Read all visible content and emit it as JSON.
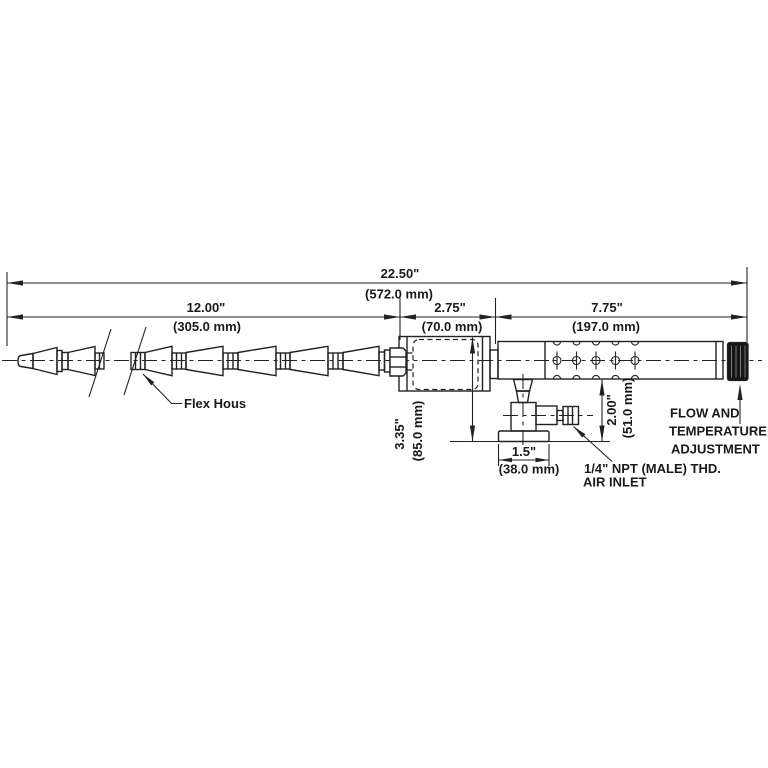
{
  "drawing": {
    "dimensions": {
      "overall": {
        "inch": "22.50\"",
        "mm": "(572.0 mm)"
      },
      "hose": {
        "inch": "12.00\"",
        "mm": "(305.0 mm)"
      },
      "body": {
        "inch": "2.75\"",
        "mm": "(70.0 mm)"
      },
      "barrel": {
        "inch": "7.75\"",
        "mm": "(197.0 mm)"
      },
      "height": {
        "inch": "3.35\"",
        "mm": "(85.0 mm)"
      },
      "inlet_height": {
        "inch": "2.00\"",
        "mm": "(51.0 mm)"
      },
      "base_width": {
        "inch": "1.5\"",
        "mm": "(38.0 mm)"
      }
    },
    "labels": {
      "flex_hose": "Flex Hous",
      "air_inlet_line1": "1/4\" NPT (MALE) THD.",
      "air_inlet_line2": "AIR INLET",
      "adjust_line1": "FLOW AND",
      "adjust_line2": "TEMPERATURE",
      "adjust_line3": "ADJUSTMENT"
    },
    "colors": {
      "line": "#222222",
      "knob": "#161616",
      "background": "#ffffff"
    }
  }
}
